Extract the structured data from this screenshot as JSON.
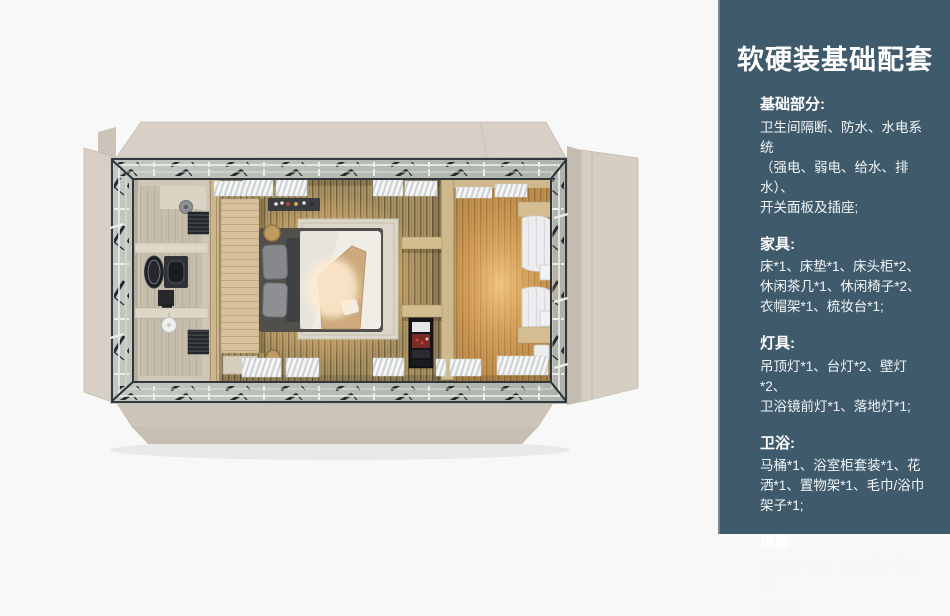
{
  "panel": {
    "title": "软硬装基础配套",
    "sections": [
      {
        "heading": "基础部分:",
        "body": "卫生间隔断、防水、水电系统\n（强电、弱电、给水、排水）、\n开关面板及插座;"
      },
      {
        "heading": "家具:",
        "body": "床*1、床垫*1、床头柜*2、\n休闲茶几*1、休闲椅子*2、\n衣帽架*1、梳妆台*1;"
      },
      {
        "heading": "灯具:",
        "body": "吊顶灯*1、台灯*2、壁灯*2、\n卫浴镜前灯*1、落地灯*1;"
      },
      {
        "heading": "卫浴:",
        "body": "马桶*1、浴室柜套装*1、花\n洒*1、置物架*1、毛巾/浴巾\n架子*1;"
      },
      {
        "heading": "地面:",
        "body": "强化木地板、卫生间防滑防潮\n石塑板;"
      }
    ]
  },
  "floorplan": {
    "description-items": [
      "unfolded-wall-panels",
      "roof-truss-frame",
      "bathroom",
      "shower-head",
      "towel-radiator",
      "vanity-sink",
      "toilet",
      "headboard-wood-panel",
      "double-bed",
      "gray-pillows",
      "area-rug",
      "wall-shelf-with-bottles",
      "woven-basket",
      "divider-wall",
      "wall-shelves",
      "black-storage-cabinet",
      "wardrobe-area-warm-light",
      "white-curtains",
      "wall-lamps",
      "window-blind-panels"
    ]
  },
  "colors": {
    "canvas-bg": "#f7f8f7",
    "panel-bg": "#3e5a6b",
    "panel-text": "#f2f6f8",
    "flap-beige": "#d8d0c6",
    "flap-beige-dark": "#cdc4b9",
    "band-gray": "#b7bcb3",
    "frame-dark": "#343a41",
    "wood-base": "#ab9463",
    "wood-line": "#6e5f41",
    "wood-warm-overlay": "#e08d34",
    "bathroom-floor": "#cfc7b7",
    "headboard-wood": "#d8c29c",
    "duvet-white": "#f0ede7",
    "pillow-gray": "#86888c",
    "blanket-tan": "#cda97c",
    "rug-beige": "#dcd7ca",
    "glow-warm": "#ffd28a",
    "cabinet-black": "#131519",
    "curtain-white": "#ededef"
  }
}
